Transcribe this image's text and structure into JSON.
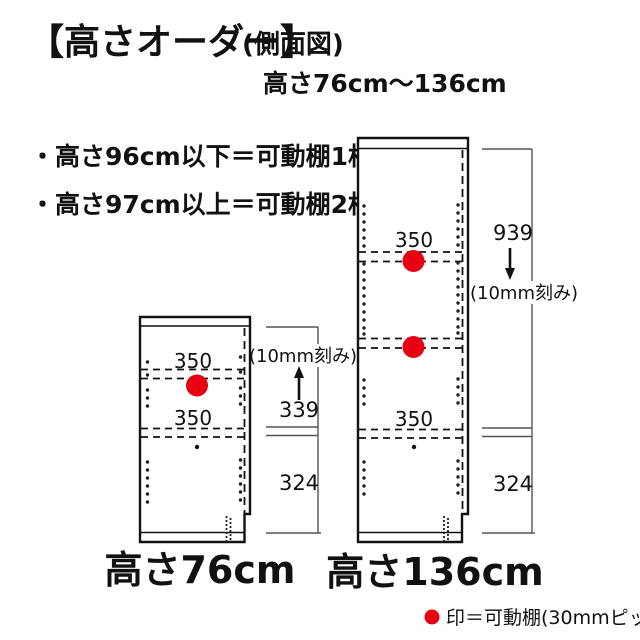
{
  "title": {
    "main": "【高さオーダー】",
    "sub": "(側面図)",
    "range": "高さ76cm～136cm"
  },
  "notes": [
    {
      "text": "・高さ96cm以下＝可動棚1枚"
    },
    {
      "text": "・高さ97cm以上＝可動棚2枚"
    }
  ],
  "cabinets": {
    "left": {
      "name": "高さ76cm",
      "shelf1_label": "350",
      "shelf2_label": "350",
      "dim_upper": "339",
      "dim_lower": "324",
      "pitch_note": "(10mm刻み)"
    },
    "right": {
      "name": "高さ136cm",
      "shelf1_label": "350",
      "shelf3_label": "350",
      "dim_upper": "939",
      "dim_lower": "324",
      "pitch_note": "(10mm刻み)"
    }
  },
  "legend": {
    "text": "印＝可動棚(30mmピッチ)"
  },
  "colors": {
    "accent_red": "#e60012",
    "line": "#111111",
    "dim_line": "#555555"
  }
}
